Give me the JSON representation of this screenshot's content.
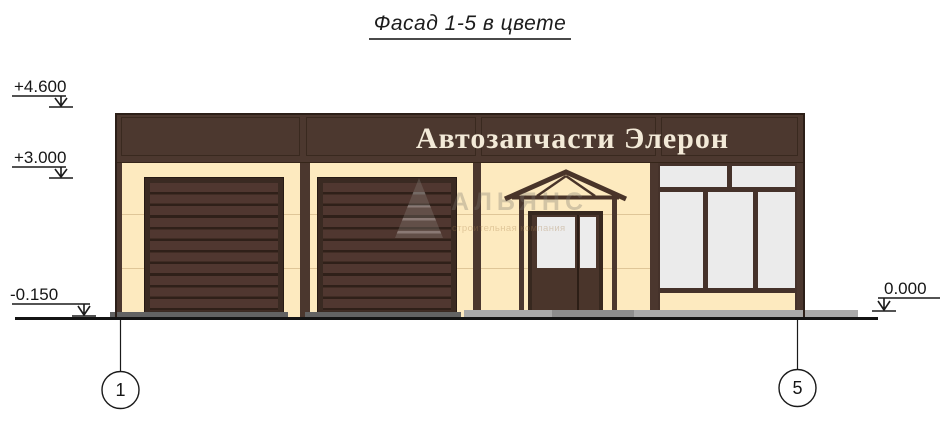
{
  "title": "Фасад 1-5 в цвете",
  "building": {
    "sign_text": "Автозапчасти Элерон"
  },
  "elevation_marks": {
    "parapet": "+4.600",
    "band": "+3.000",
    "ground": "-0.150",
    "entry": "0.000"
  },
  "axis_bubbles": {
    "left": "1",
    "right": "5"
  },
  "watermark": {
    "brand": "АЛЬЯНС",
    "tagline": "строительная компания"
  },
  "colors": {
    "band_brown": "#4c382f",
    "wall_cream": "#fdeabf",
    "door_brown": "#503730",
    "door_frame": "#3a2a22",
    "glass_white": "#ebebeb",
    "pavement_gray": "#a9a9a9",
    "threshold_gray": "#636363",
    "line_black": "#161616"
  }
}
